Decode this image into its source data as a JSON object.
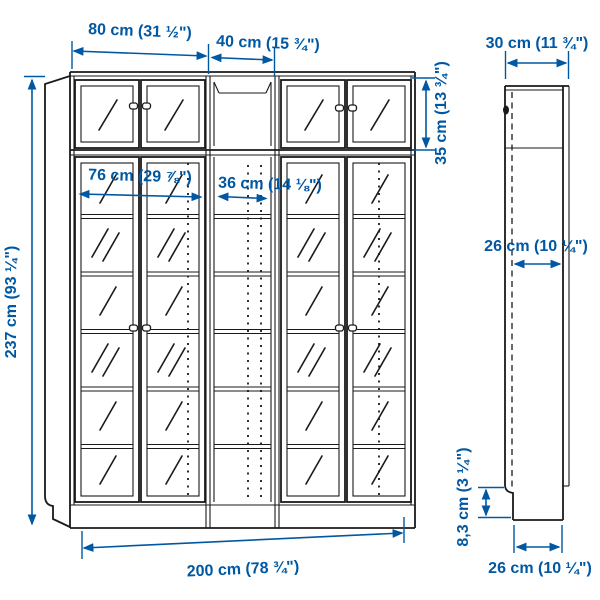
{
  "page": {
    "description": "Bookcase combination with glass doors and height extension units - dimension line drawing",
    "background": "#ffffff",
    "accent_color": "#0058a3",
    "line_color": "#1a1a1a"
  },
  "front_view": {
    "labels": {
      "unit_width_80": "80 cm (31 ½\")",
      "unit_width_40": "40 cm (15 ¾\")",
      "interior_width_76": "76 cm (29 ⅞\")",
      "interior_width_36": "36 cm (14 ⅛\")",
      "total_height_237": "237 cm (93 ¼\")",
      "extension_height_35": "35 cm (13 ¾\")",
      "total_width_200": "200 cm (78 ¾\")"
    }
  },
  "side_view": {
    "labels": {
      "depth_30": "30 cm (11 ¾\")",
      "interior_depth_26": "26 cm (10 ¼\")",
      "plinth_height_83": "8,3 cm (3 ¼\")",
      "base_depth_26": "26 cm (10 ¼\")"
    }
  }
}
